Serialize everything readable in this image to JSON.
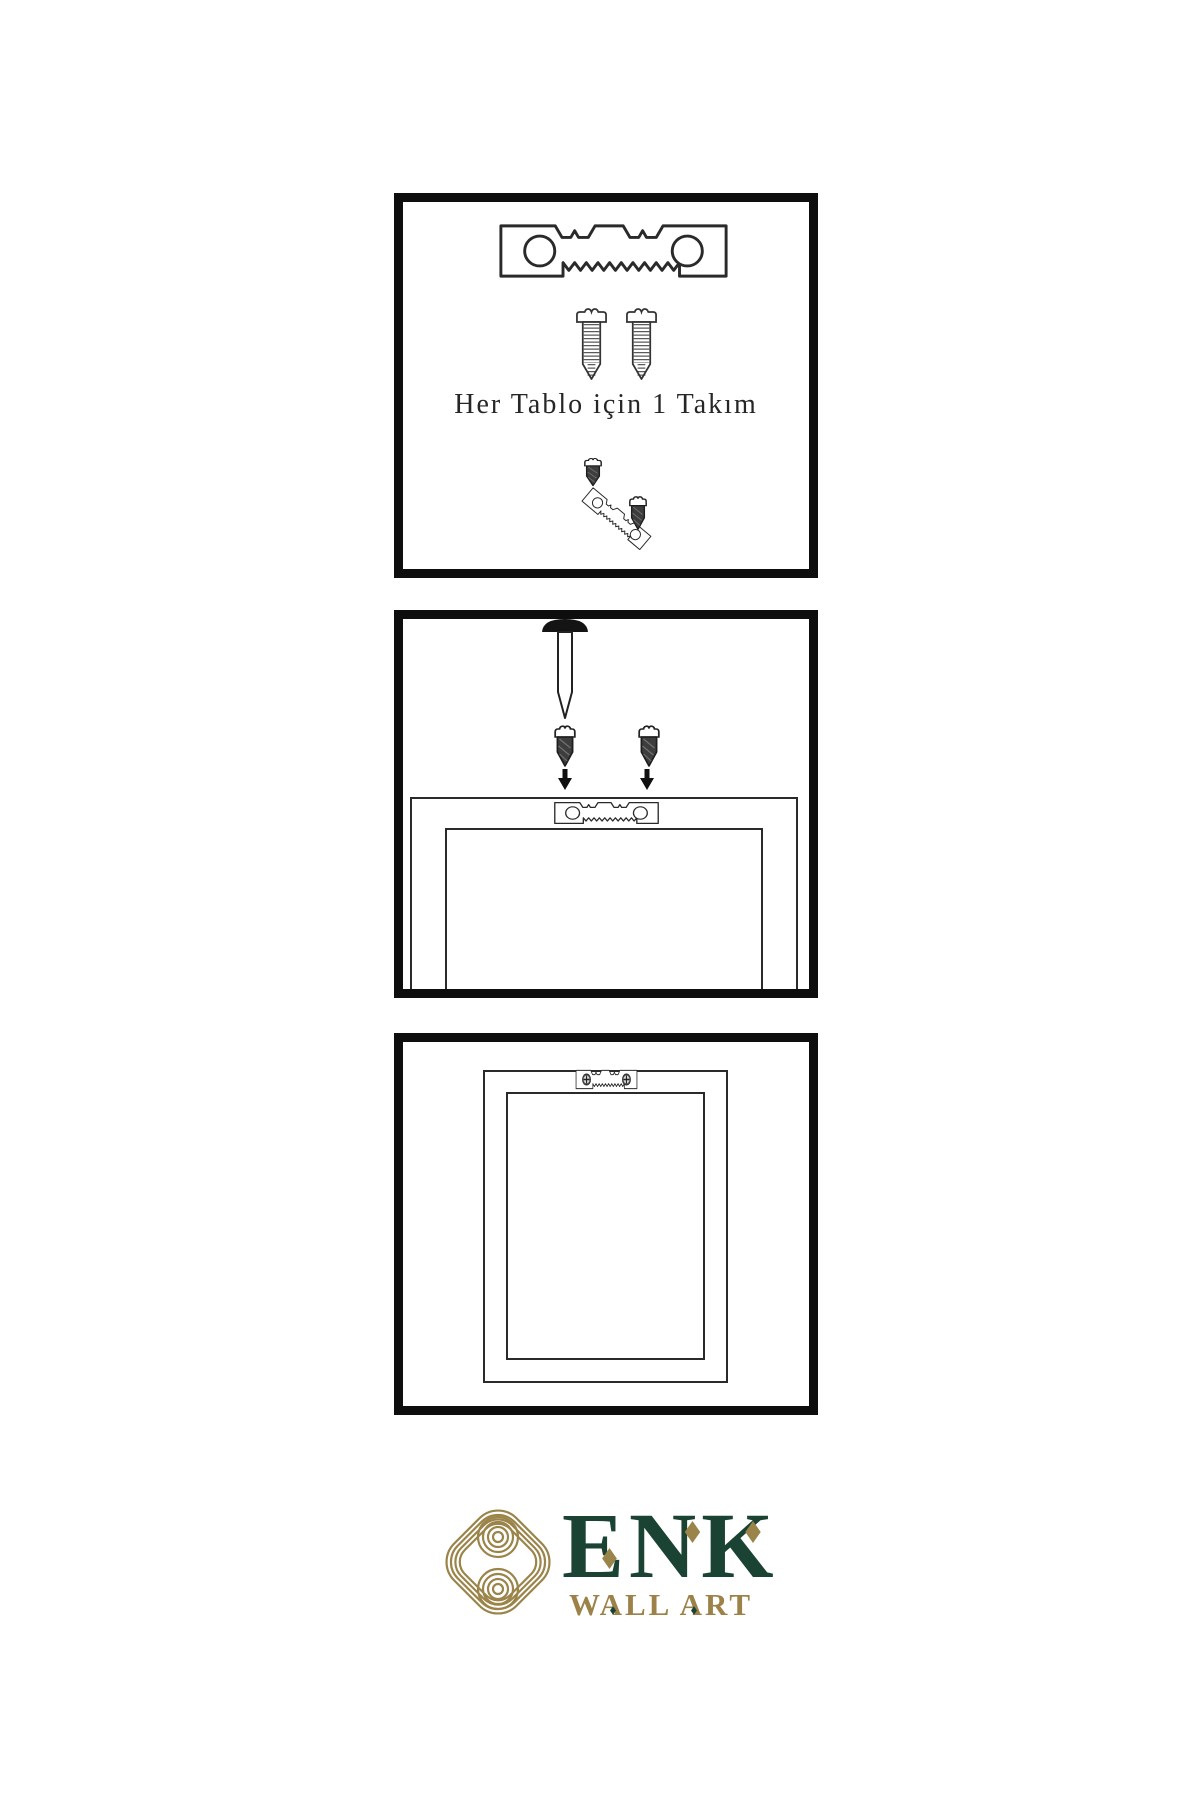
{
  "colors": {
    "line_art": "#2a2a2a",
    "panel_border": "#0e0e0e",
    "logo_gold": "#9a8449",
    "logo_green": "#1b4334"
  },
  "panels": {
    "kit": {
      "caption": "Her Tablo için 1 Takım",
      "icons": [
        "sawtooth-hanger",
        "screw",
        "screw",
        "screw-into-tilted-hanger"
      ]
    },
    "install": {
      "icons": [
        "wall-nail",
        "screw",
        "screw",
        "down-arrow",
        "down-arrow",
        "sawtooth-hanger",
        "frame-back"
      ]
    },
    "hang": {
      "icons": [
        "frame-back",
        "mounted-sawtooth-hanger-with-screws"
      ]
    }
  },
  "logo": {
    "title": "ENK",
    "subtitle": "WALL ART",
    "icon": "interlaced-knot"
  }
}
